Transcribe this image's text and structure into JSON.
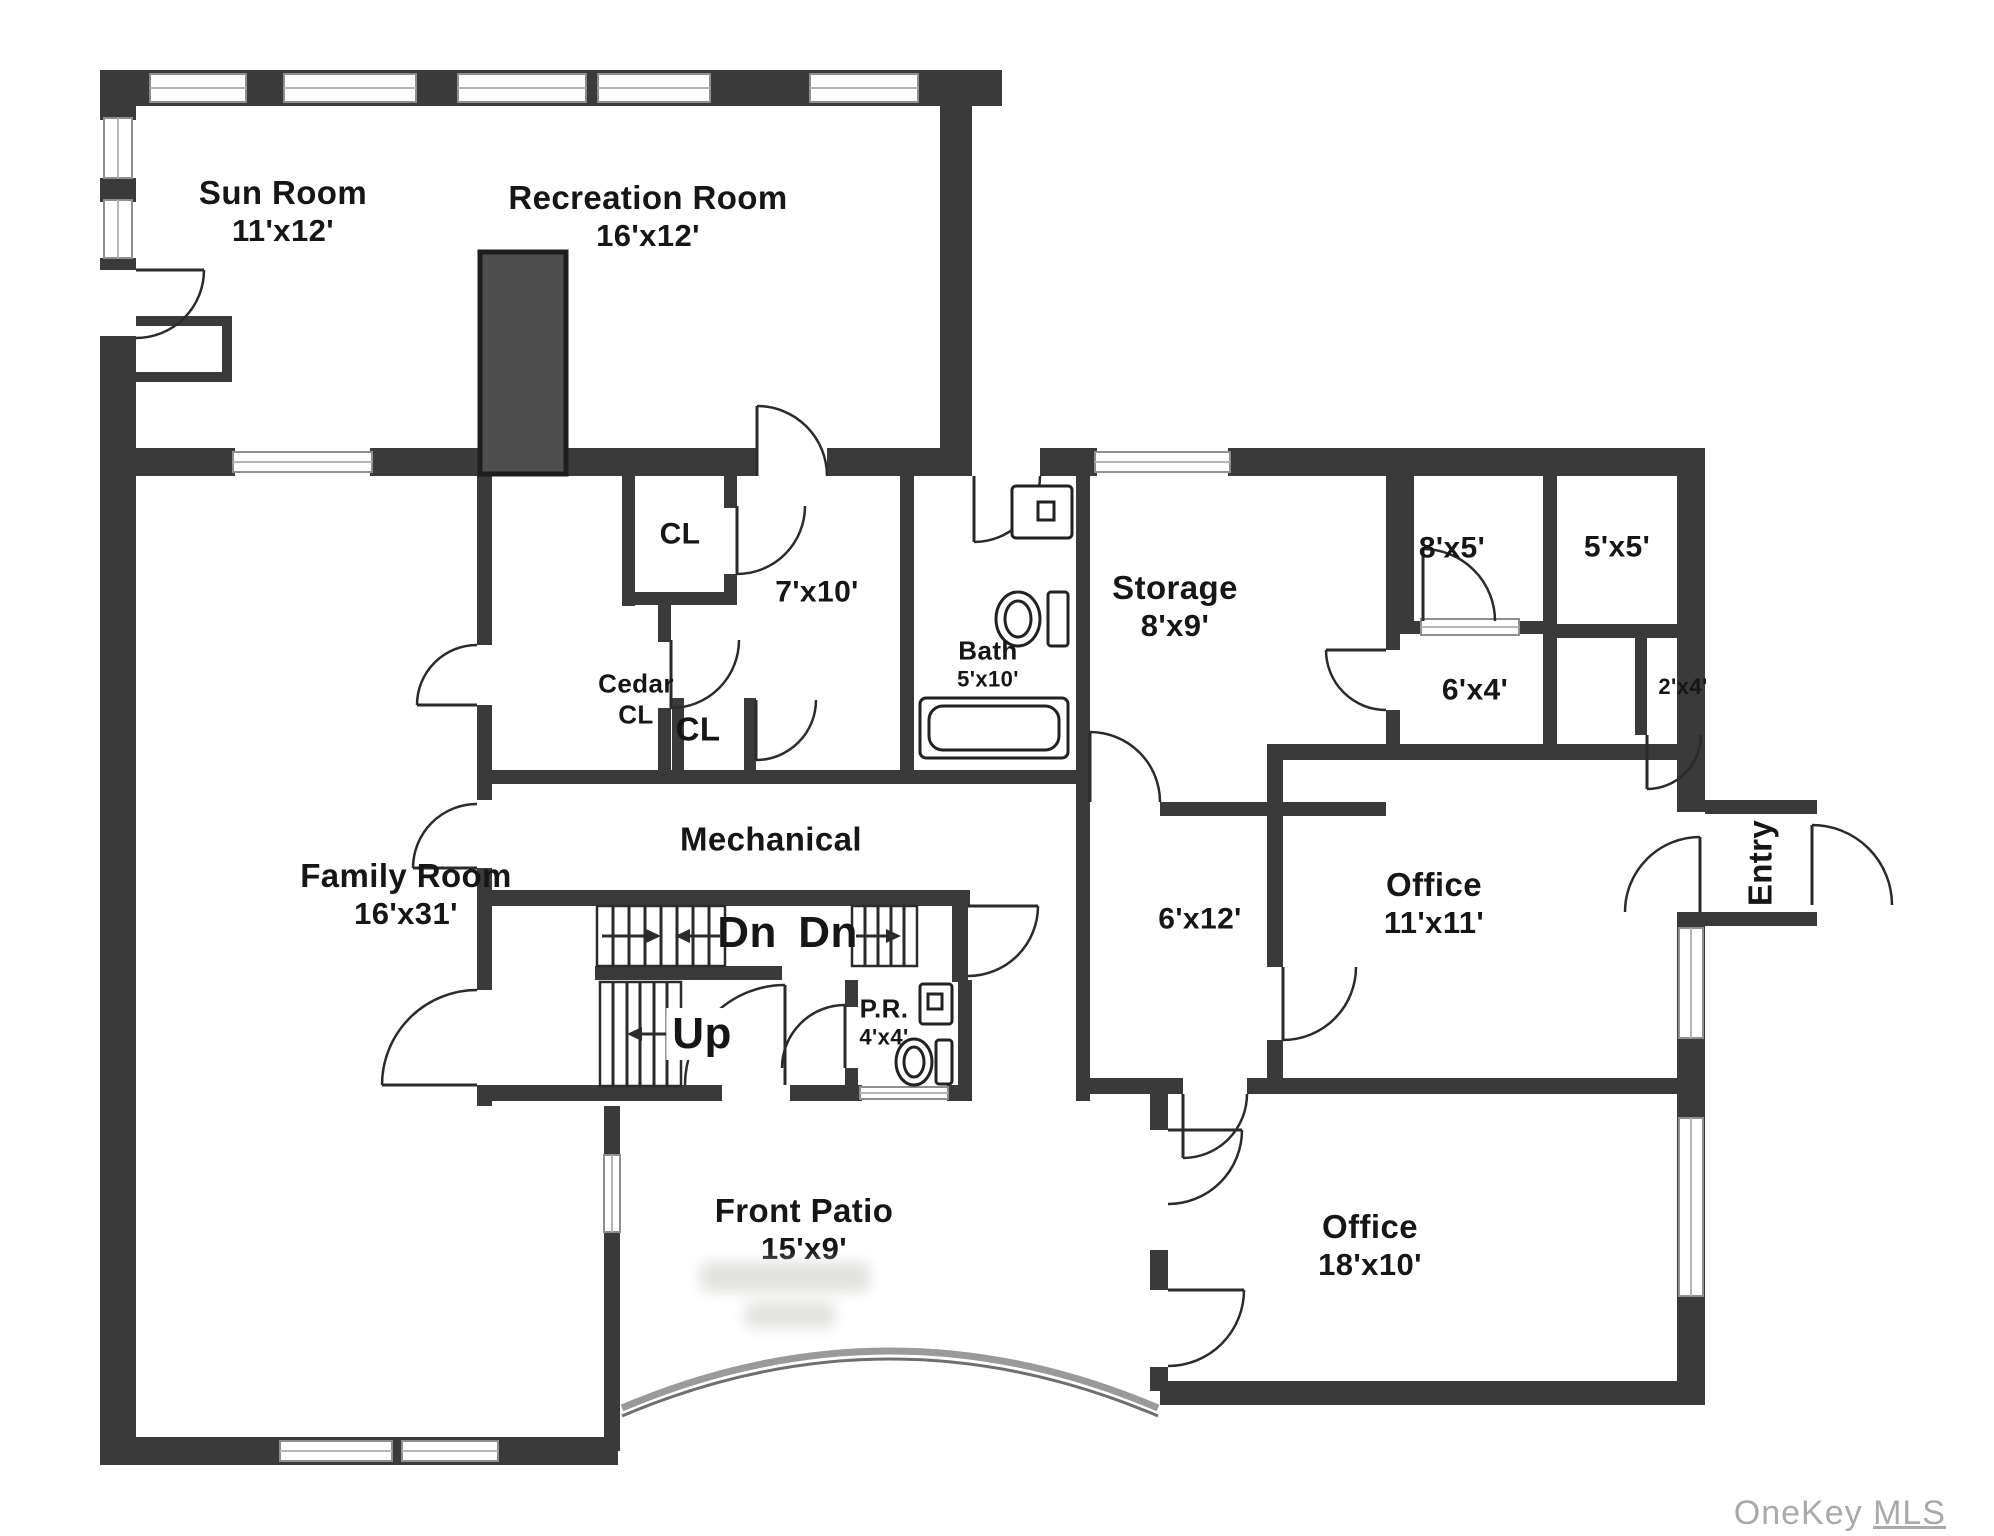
{
  "palette": {
    "wall": "#3a3a3a",
    "chimney_fill": "#4e4e4e",
    "paper": "#ffffff",
    "watermark": "#a9a9a9"
  },
  "rooms": {
    "sun_room": {
      "name": "Sun Room",
      "dims": "11'x12'"
    },
    "recreation": {
      "name": "Recreation Room",
      "dims": "16'x12'"
    },
    "family_room": {
      "name": "Family Room",
      "dims": "16'x31'"
    },
    "closet_top": {
      "name": "CL"
    },
    "room_7x10": {
      "dims": "7'x10'"
    },
    "cedar_closet": {
      "line1": "Cedar",
      "line2": "CL"
    },
    "closet_small": {
      "name": "CL"
    },
    "bath": {
      "name": "Bath",
      "dims": "5'x10'"
    },
    "mechanical": {
      "name": "Mechanical"
    },
    "storage": {
      "name": "Storage",
      "dims": "8'x9'"
    },
    "room_8x5": {
      "dims": "8'x5'"
    },
    "room_5x5": {
      "dims": "5'x5'"
    },
    "room_6x4": {
      "dims": "6'x4'"
    },
    "closet_2x4": {
      "dims": "2'x4'"
    },
    "hall_6x12": {
      "dims": "6'x12'"
    },
    "office_11x11": {
      "name": "Office",
      "dims": "11'x11'"
    },
    "entry": {
      "name": "Entry"
    },
    "powder_room": {
      "name": "P.R.",
      "dims": "4'x4'"
    },
    "front_patio": {
      "name": "Front Patio",
      "dims": "15'x9'"
    },
    "office_18x10": {
      "name": "Office",
      "dims": "18'x10'"
    }
  },
  "stairs": {
    "down_label_1": "Dn",
    "down_label_2": "Dn",
    "up_label": "Up"
  },
  "watermark": {
    "brand": "OneKey",
    "suffix": "MLS"
  }
}
